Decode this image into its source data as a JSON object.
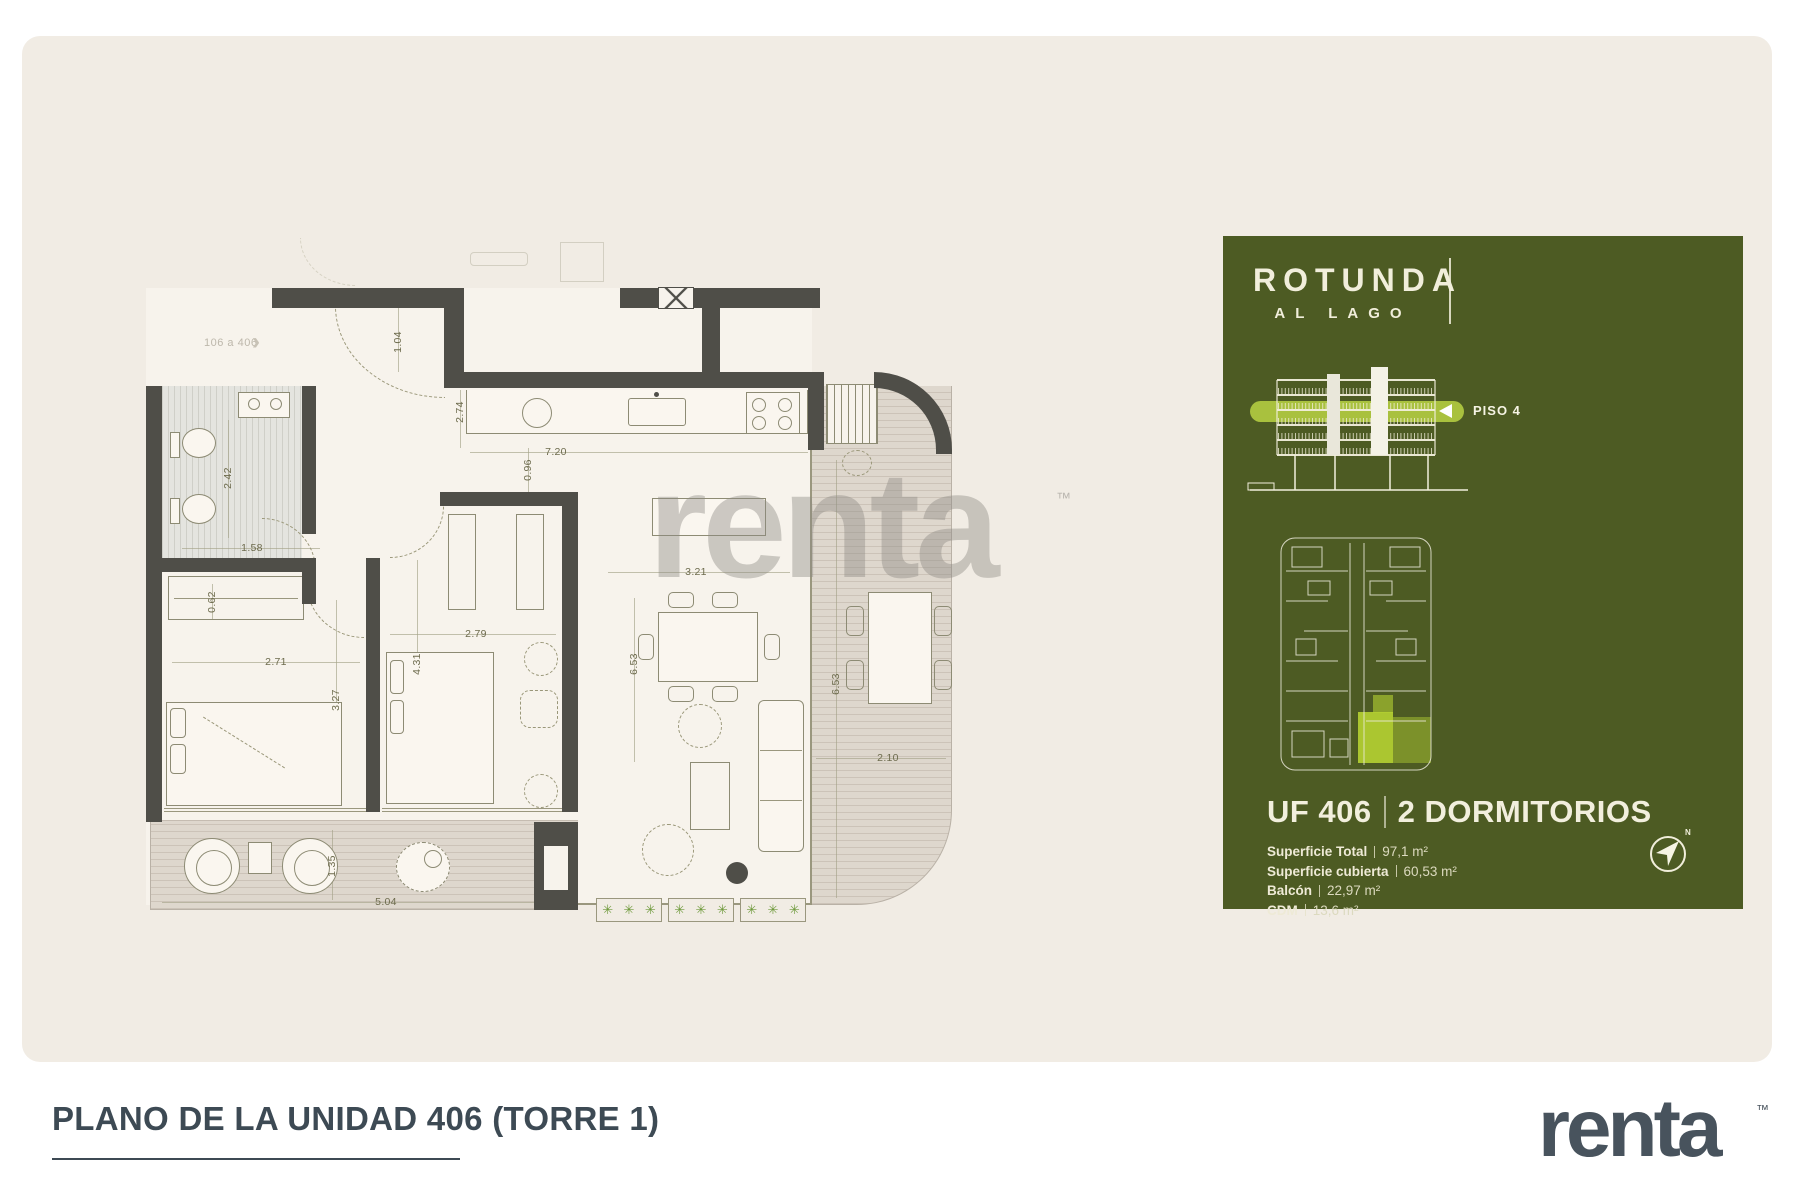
{
  "page": {
    "title": "PLANO DE LA UNIDAD 406 (TORRE 1)",
    "logo": "renta",
    "logo_tm": "™",
    "watermark": "renta",
    "watermark_tm": "™"
  },
  "colors": {
    "board_beige": "#f1ece4",
    "panel_green": "#4d5b23",
    "highlight_green": "#a9c13e",
    "wall": "#4f4e48",
    "title_slate": "#3d4a54",
    "logo_slate": "#48535d",
    "plant_green": "#6f9a3c"
  },
  "floor_plan": {
    "unit_ref": "106 a 406",
    "unit_ref_arrow": "›",
    "plant_glyph": "✳",
    "dimensions": [
      {
        "t": "1.04",
        "x": 398,
        "y": 342,
        "r": 90
      },
      {
        "t": "2.74",
        "x": 460,
        "y": 412,
        "r": 90
      },
      {
        "t": "7.20",
        "x": 556,
        "y": 452,
        "r": 0
      },
      {
        "t": "0.96",
        "x": 528,
        "y": 470,
        "r": 90
      },
      {
        "t": "2.42",
        "x": 228,
        "y": 478,
        "r": 90
      },
      {
        "t": "1.58",
        "x": 252,
        "y": 548,
        "r": 0
      },
      {
        "t": "0.62",
        "x": 212,
        "y": 602,
        "r": 90
      },
      {
        "t": "2.71",
        "x": 276,
        "y": 662,
        "r": 0
      },
      {
        "t": "3.27",
        "x": 336,
        "y": 700,
        "r": 90
      },
      {
        "t": "4.31",
        "x": 417,
        "y": 664,
        "r": 90
      },
      {
        "t": "2.79",
        "x": 476,
        "y": 634,
        "r": 0
      },
      {
        "t": "3.21",
        "x": 696,
        "y": 572,
        "r": 0
      },
      {
        "t": "6.53",
        "x": 634,
        "y": 664,
        "r": 90
      },
      {
        "t": "6.53",
        "x": 836,
        "y": 684,
        "r": 90
      },
      {
        "t": "2.10",
        "x": 888,
        "y": 758,
        "r": 0
      },
      {
        "t": "1.35",
        "x": 332,
        "y": 866,
        "r": 90
      },
      {
        "t": "5.04",
        "x": 386,
        "y": 902,
        "r": 0
      }
    ]
  },
  "panel": {
    "brand_line1": "ROTUNDA",
    "brand_line2": "AL LAGO",
    "floor_badge": "PISO 4",
    "unit_title": "UF 406",
    "unit_subtitle": "2 DORMITORIOS",
    "specs": [
      {
        "label": "Superficie Total",
        "value": "97,1 m²"
      },
      {
        "label": "Superficie cubierta",
        "value": "60,53 m²"
      },
      {
        "label": "Balcón",
        "value": "22,97 m²"
      },
      {
        "label": "CDM",
        "value": "13,6 m²"
      }
    ],
    "compass_n": "N"
  }
}
